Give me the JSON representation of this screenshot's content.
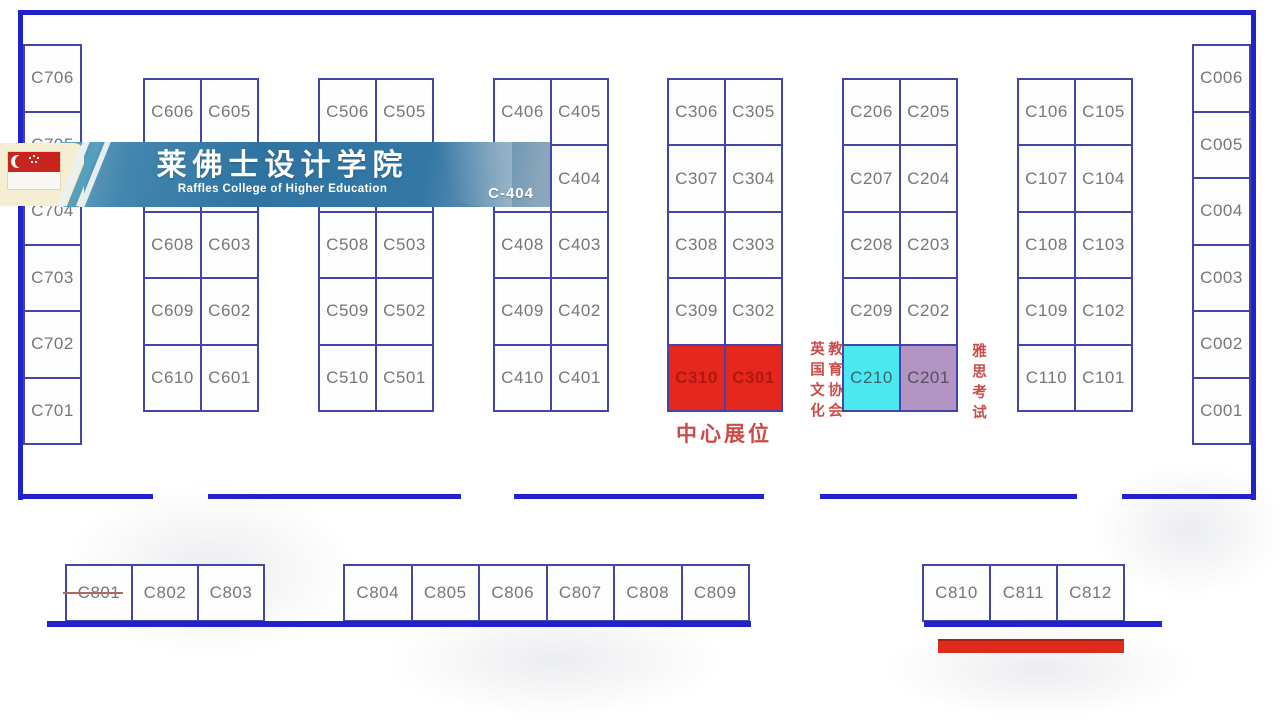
{
  "banner": {
    "title": "莱佛士设计学院",
    "subtitle": "Raffles College of Higher Education",
    "booth_ref": "C-404",
    "flag": "singapore-flag"
  },
  "annotations": {
    "center_booth_label": "中心展位",
    "left_vertical_text_col1": "英国文化",
    "left_vertical_text_col2": "教育协会",
    "right_vertical_text": "雅思考试"
  },
  "floorplan": {
    "left_wall_booths": [
      "C706",
      "C705",
      "C704",
      "C703",
      "C702",
      "C701"
    ],
    "right_wall_booths": [
      "C006",
      "C005",
      "C004",
      "C003",
      "C002",
      "C001"
    ],
    "island_columns": [
      {
        "name": "c600-block",
        "rows": [
          [
            "C606",
            "C605"
          ],
          [
            "",
            ""
          ],
          [
            "C608",
            "C603"
          ],
          [
            "C609",
            "C602"
          ],
          [
            "C610",
            "C601"
          ]
        ]
      },
      {
        "name": "c500-block",
        "rows": [
          [
            "C506",
            "C505"
          ],
          [
            "",
            ""
          ],
          [
            "C508",
            "C503"
          ],
          [
            "C509",
            "C502"
          ],
          [
            "C510",
            "C501"
          ]
        ]
      },
      {
        "name": "c400-block",
        "rows": [
          [
            "C406",
            "C405"
          ],
          [
            "",
            "C404"
          ],
          [
            "C408",
            "C403"
          ],
          [
            "C409",
            "C402"
          ],
          [
            "C410",
            "C401"
          ]
        ]
      },
      {
        "name": "c300-block",
        "rows": [
          [
            "C306",
            "C305"
          ],
          [
            "C307",
            "C304"
          ],
          [
            "C308",
            "C303"
          ],
          [
            "C309",
            "C302"
          ],
          [
            "C310",
            "C301"
          ]
        ]
      },
      {
        "name": "c200-block",
        "rows": [
          [
            "C206",
            "C205"
          ],
          [
            "C207",
            "C204"
          ],
          [
            "C208",
            "C203"
          ],
          [
            "C209",
            "C202"
          ],
          [
            "C210",
            "C201"
          ]
        ]
      },
      {
        "name": "c100-block",
        "rows": [
          [
            "C106",
            "C105"
          ],
          [
            "C107",
            "C104"
          ],
          [
            "C108",
            "C103"
          ],
          [
            "C109",
            "C102"
          ],
          [
            "C110",
            "C101"
          ]
        ]
      }
    ],
    "bottom_row_groups": [
      [
        "C801",
        "C802",
        "C803"
      ],
      [
        "C804",
        "C805",
        "C806",
        "C807",
        "C808",
        "C809"
      ],
      [
        "C810",
        "C811",
        "C812"
      ]
    ],
    "struck_booths": [
      "C801"
    ],
    "highlighted_booths": {
      "C310": "red",
      "C301": "red",
      "C210": "cyan",
      "C201": "purple"
    }
  },
  "colors": {
    "wall": "#2121CE",
    "booth_border": "#4544A9",
    "booth_label": "#77777B",
    "highlight_red": "#E5271D",
    "highlight_red_label": "#9E120D",
    "highlight_cyan": "#4BE8F0",
    "highlight_cyan_label": "#3C6470",
    "highlight_purple": "#B394C3",
    "highlight_purple_label": "#54505F",
    "annotation_red": "#CC4B47",
    "banner_cream": "#F6EED3",
    "flag_red": "#C8251F",
    "bottom_red_bar": "#DF2B1C"
  }
}
